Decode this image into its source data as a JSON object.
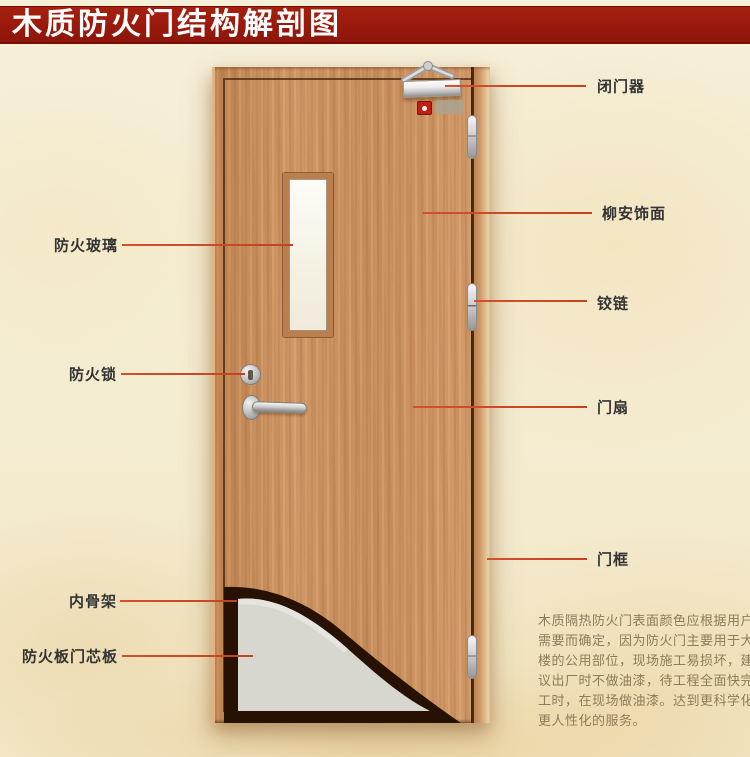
{
  "title": {
    "text": "木质防火门结构解剖图"
  },
  "annotations": {
    "left": [
      {
        "label": "防火玻璃"
      },
      {
        "label": "防火锁"
      },
      {
        "label": "内骨架"
      },
      {
        "label": "防火板门芯板"
      }
    ],
    "right": [
      {
        "label": "闭门器"
      },
      {
        "label": "柳安饰面"
      },
      {
        "label": "铰链"
      },
      {
        "label": "门扇"
      },
      {
        "label": "门框"
      }
    ]
  },
  "note": {
    "lines": [
      "木质隔热防火门表面颜色应根据用户",
      "需要而确定，因为防火门主要用于大",
      "楼的公用部位，现场施工易损坏，建",
      "议出厂时不做油漆，待工程全面快完",
      "工时，在现场做油漆。达到更科学化",
      "更人性化的服务。"
    ]
  },
  "colors": {
    "banner_red": "#9d1a0e",
    "leader_red": "#cf4527",
    "door_wood": "#c98f62",
    "core_board_gray": "#d8d7cf",
    "inner_skeleton_dark": "#261103",
    "glass_white": "#fbfaf2",
    "background_cream": "#f4ecd2"
  }
}
